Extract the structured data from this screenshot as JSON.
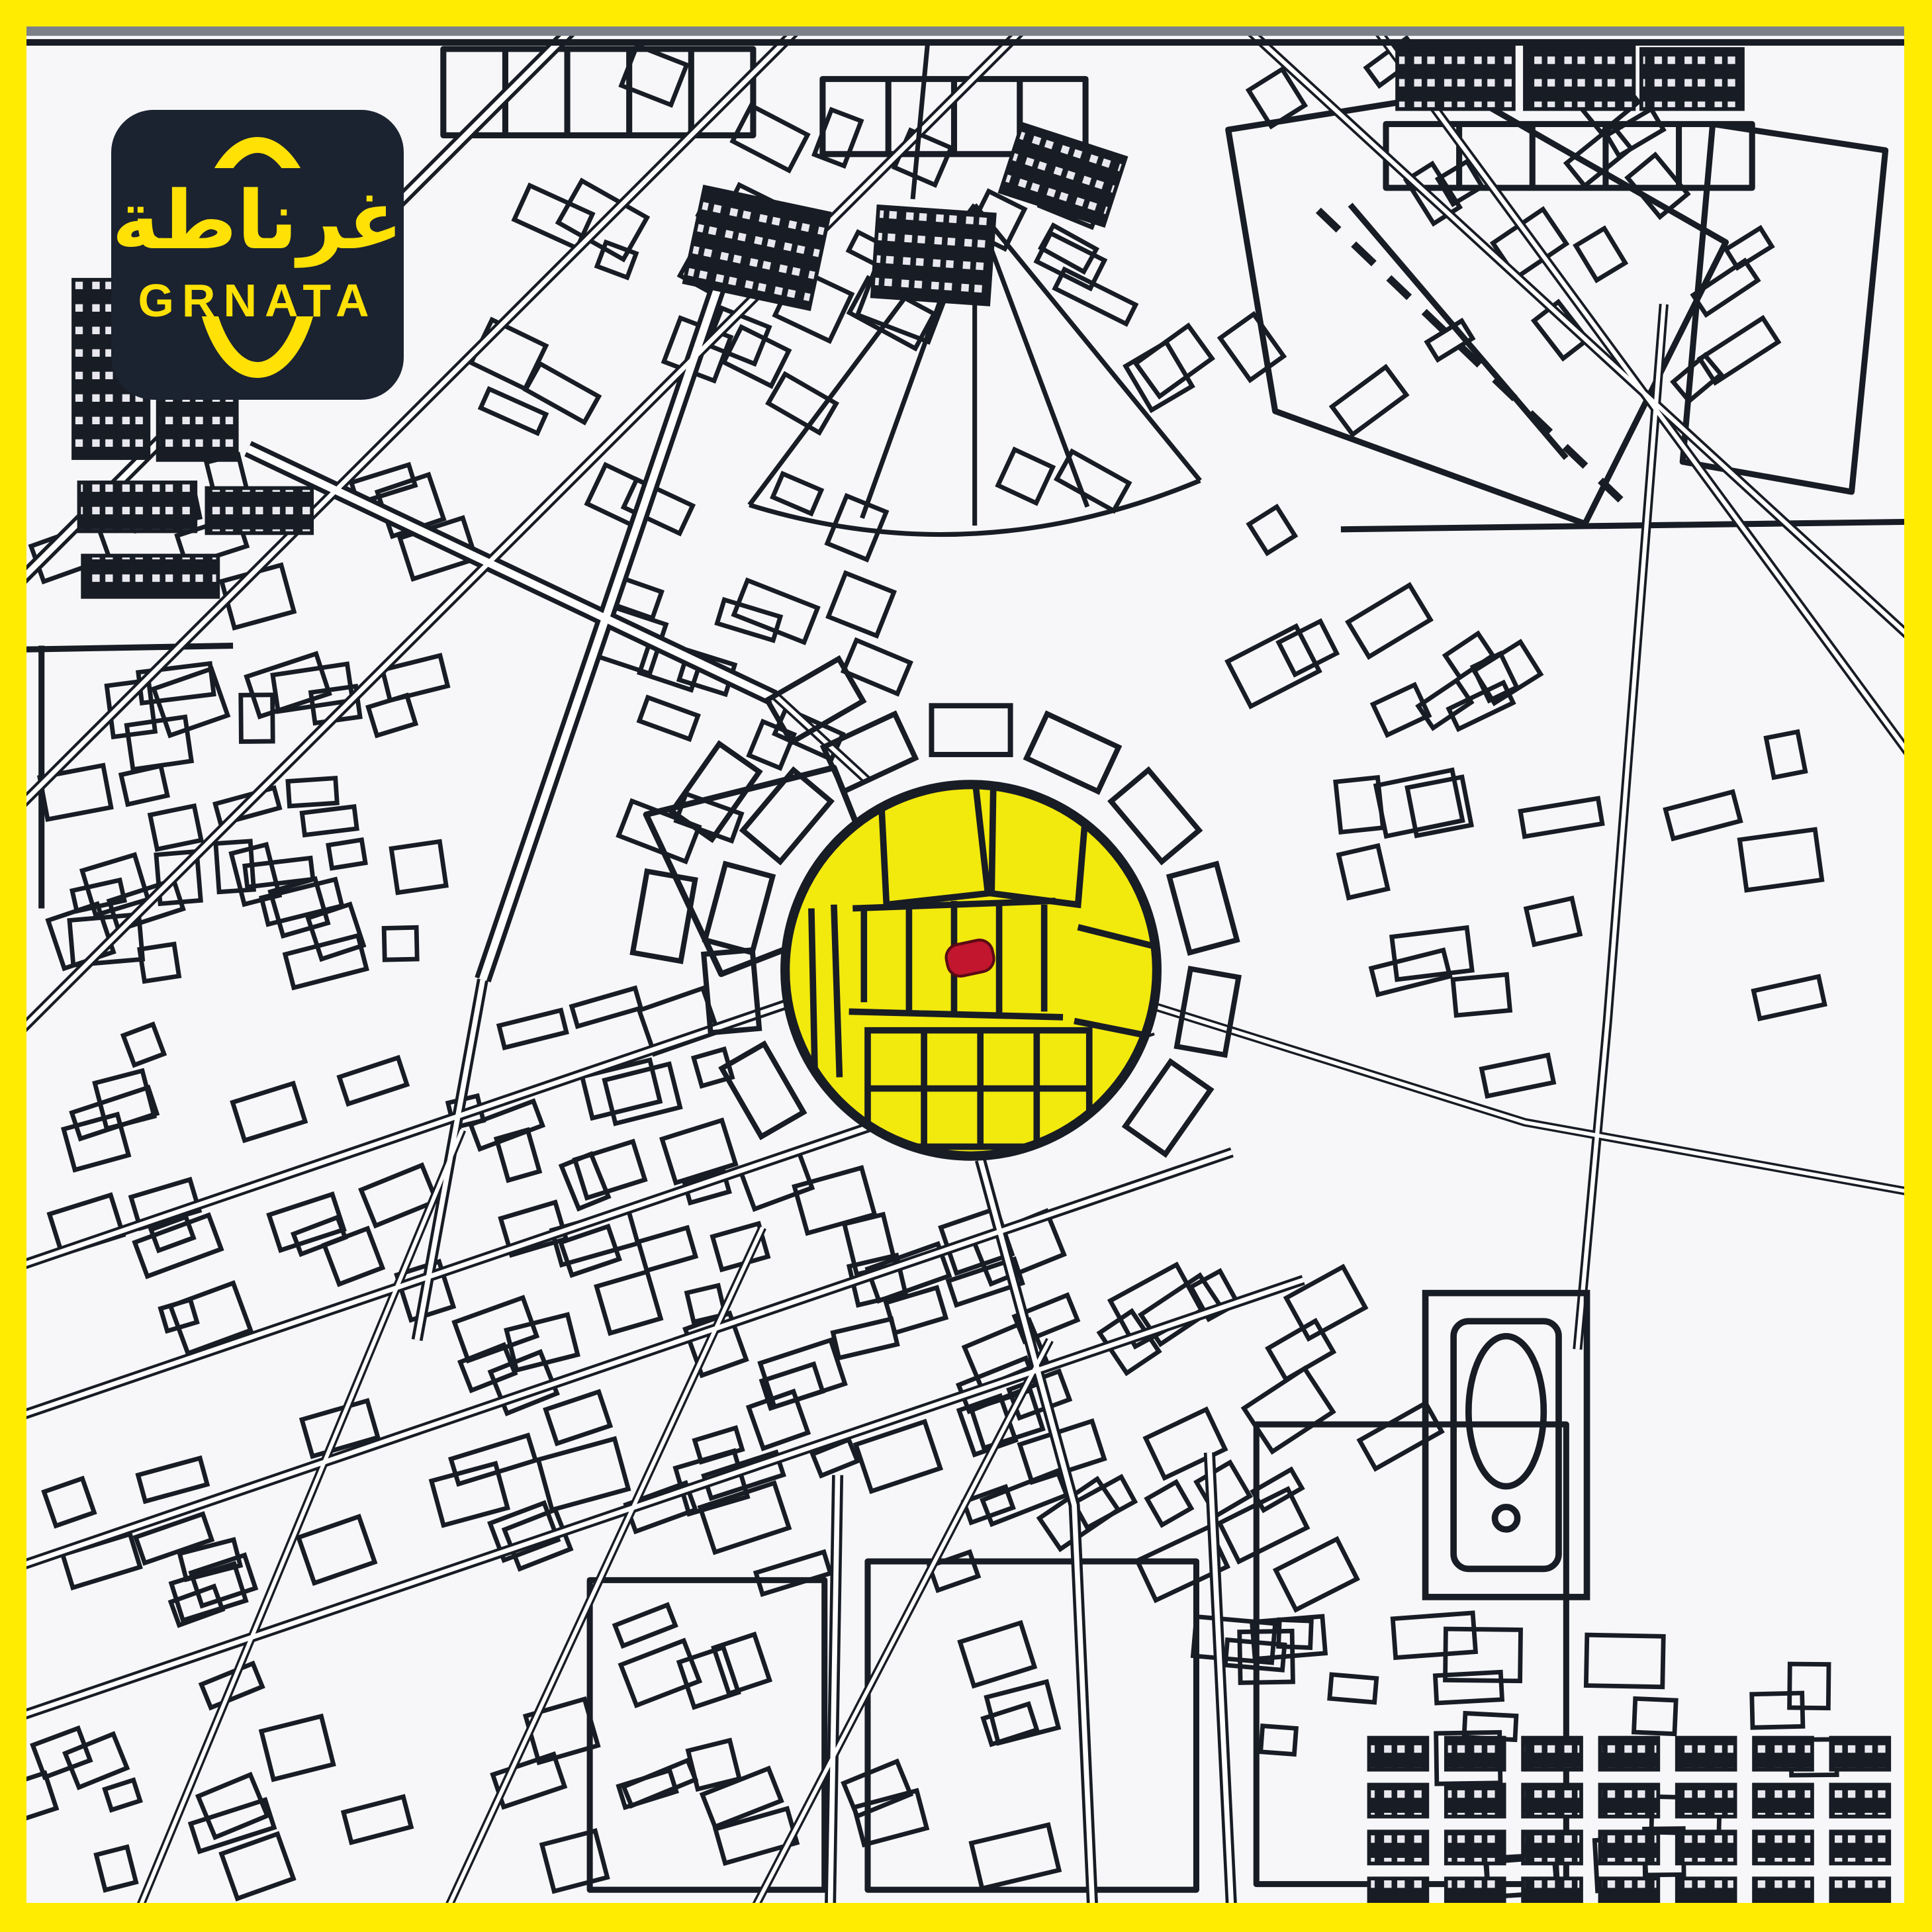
{
  "logo": {
    "arabic": "غرناطة",
    "latin": "GRNATA"
  },
  "map": {
    "colors": {
      "frame_yellow": "#FFEC00",
      "paper": "#F7F7FA",
      "ink": "#181C24",
      "road_fill": "#FFFFFF",
      "highlight_yellow": "#F2E90D",
      "marker_red": "#C2152E",
      "logo_bg": "#1B2230",
      "logo_yellow": "#FFE105",
      "scan_edge_gray": "#7C8089"
    }
  }
}
